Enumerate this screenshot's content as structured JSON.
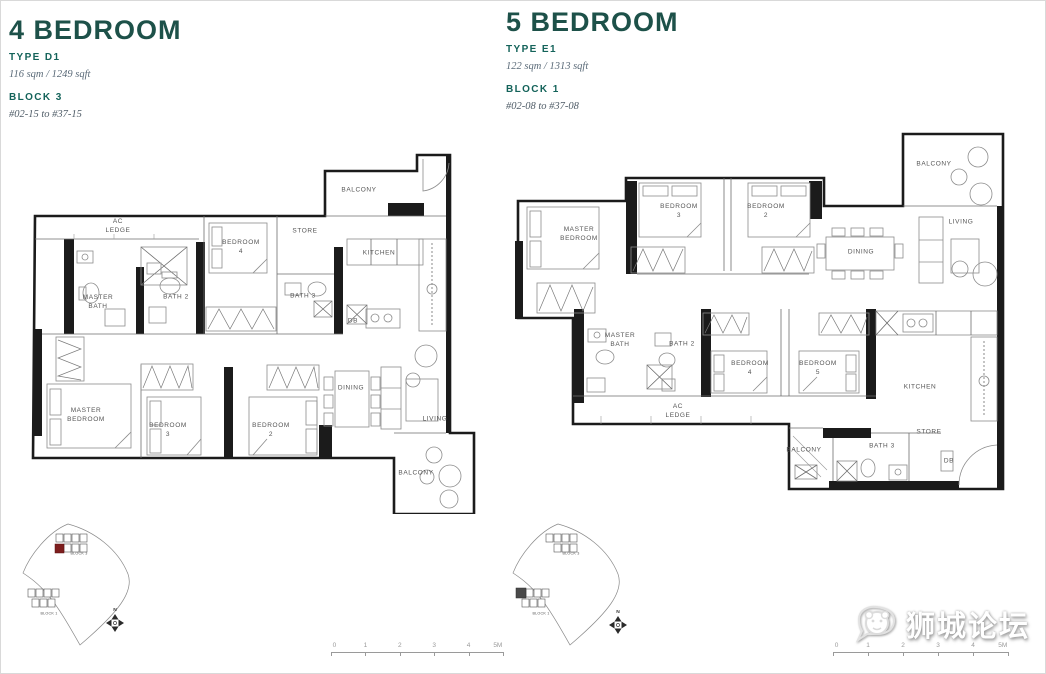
{
  "colors": {
    "heading_teal": "#1d5149",
    "label_teal": "#14635a",
    "highlight_red": "#7d1d1d",
    "wall_black": "#1b1b1b"
  },
  "plans": [
    {
      "title": "4 BEDROOM",
      "type_label": "TYPE D1",
      "area": "116 sqm / 1249 sqft",
      "block": "BLOCK 3",
      "units": "#02-15 to #37-15",
      "rooms": [
        "AC\nLEDGE",
        "BALCONY",
        "BEDROOM\n4",
        "STORE",
        "KITCHEN",
        "MASTER\nBATH",
        "BATH 2",
        "BATH 3",
        "DB",
        "MASTER\nBEDROOM",
        "BEDROOM\n3",
        "BEDROOM\n2",
        "DINING",
        "LIVING",
        "BALCONY"
      ]
    },
    {
      "title": "5 BEDROOM",
      "type_label": "TYPE E1",
      "area": "122 sqm / 1313 sqft",
      "block": "BLOCK 1",
      "units": "#02-08 to #37-08",
      "rooms": [
        "BALCONY",
        "MASTER\nBEDROOM",
        "BEDROOM\n3",
        "BEDROOM\n2",
        "LIVING",
        "DINING",
        "MASTER\nBATH",
        "BATH 2",
        "BEDROOM\n4",
        "BEDROOM\n5",
        "KITCHEN",
        "AC\nLEDGE",
        "BALCONY",
        "BATH 3",
        "STORE",
        "DB"
      ]
    }
  ],
  "site_key": {
    "north_label": "N",
    "blocks": [
      "BLOCK 3",
      "BLOCK 1"
    ]
  },
  "scale_bar": {
    "ticks": [
      "0",
      "1",
      "2",
      "3",
      "4",
      "5M"
    ]
  },
  "watermark": {
    "text": "狮城论坛"
  }
}
